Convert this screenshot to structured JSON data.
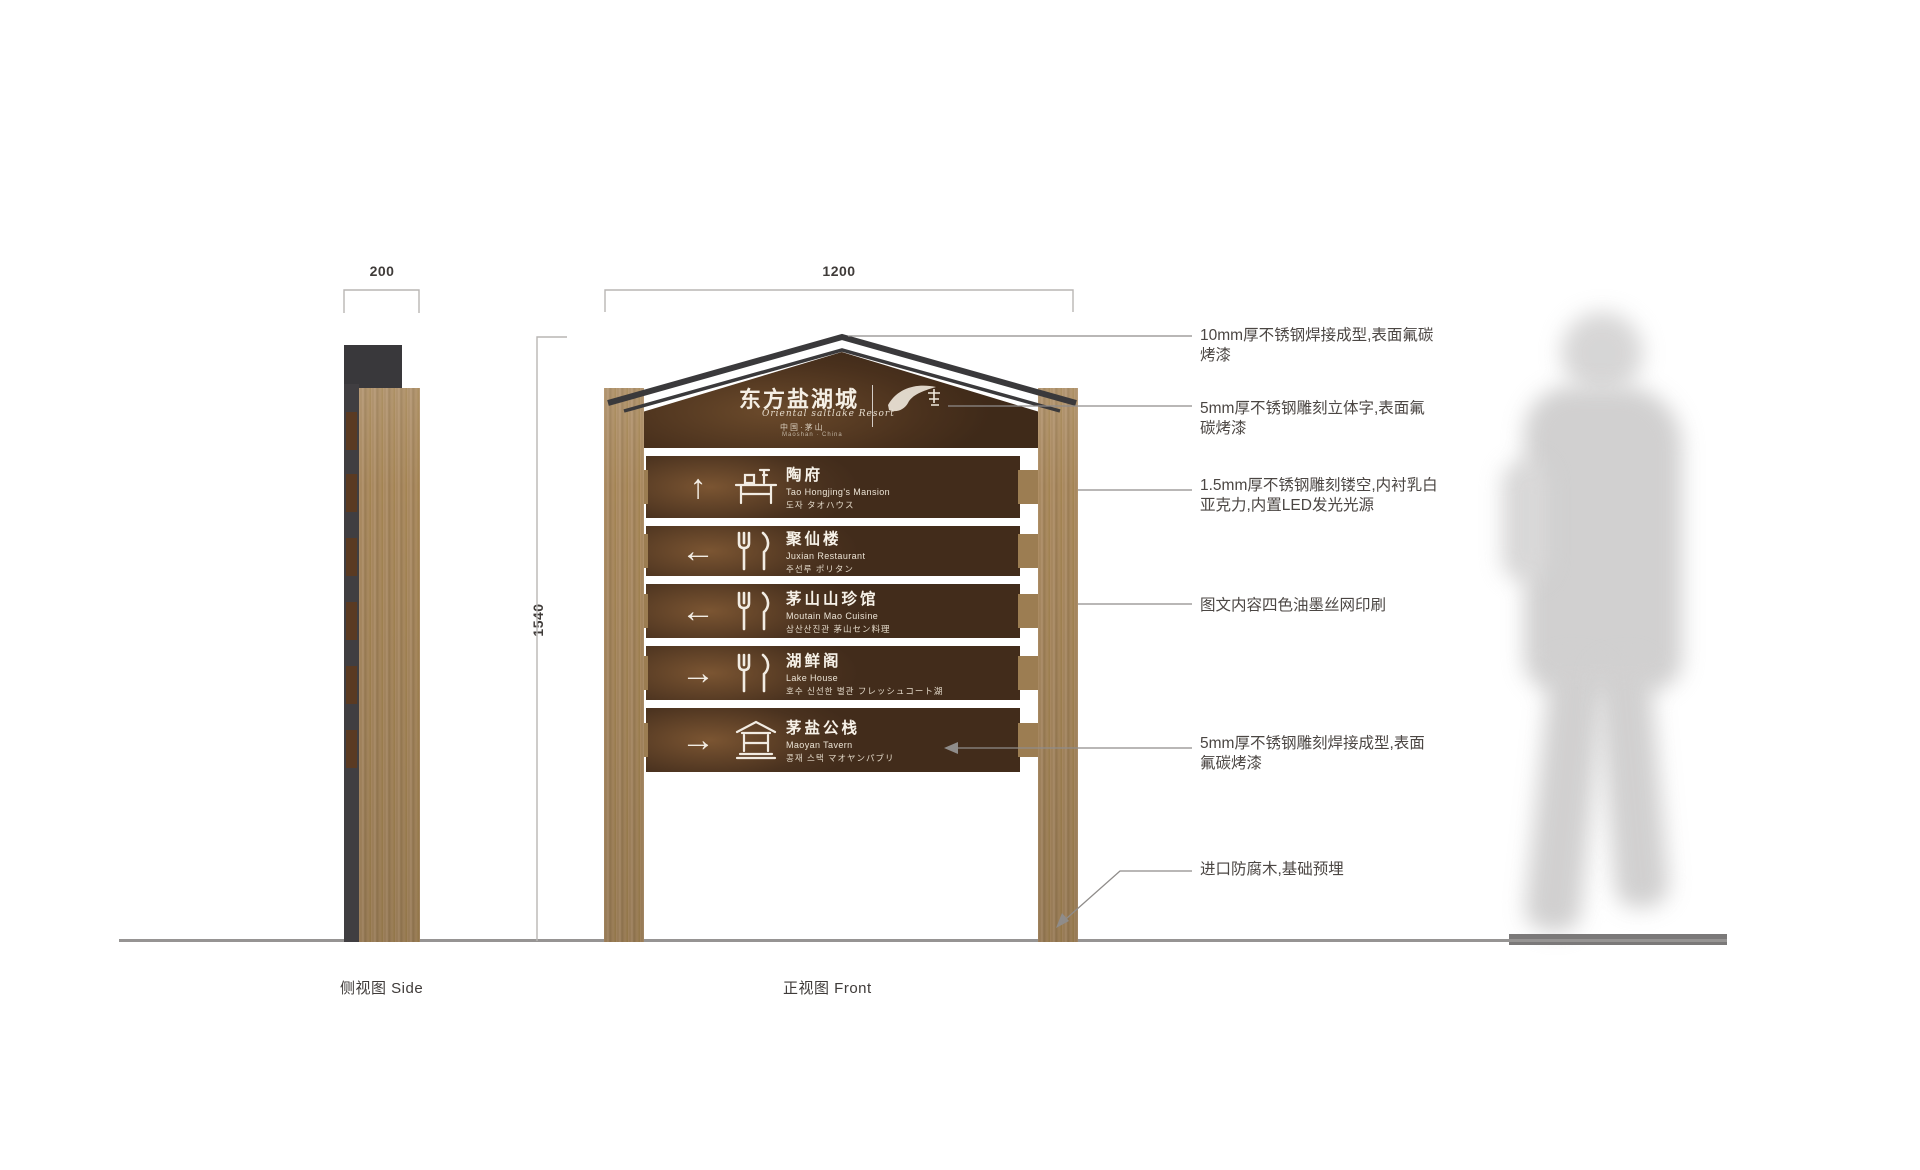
{
  "title_block": {
    "side_view_label": "侧视图 Side",
    "front_view_label": "正视图 Front"
  },
  "dimensions": {
    "side_width": "200",
    "front_width": "1200",
    "total_height": "1540"
  },
  "header": {
    "title": "东方盐湖城",
    "script_line": "Oriental saltlake Resort",
    "origin_line1": "中国·茅山",
    "origin_line2": "Maoshan · China"
  },
  "rows": [
    {
      "arrow": "up",
      "arrow_glyph": "↑",
      "icon": "mansion",
      "name_cn": "陶府",
      "name_en": "Tao Hongjing's Mansion",
      "name_intl": "도자 タオハウス"
    },
    {
      "arrow": "left",
      "arrow_glyph": "←",
      "icon": "dining",
      "name_cn": "聚仙楼",
      "name_en": "Juxian Restaurant",
      "name_intl": "주선루 ポリタン"
    },
    {
      "arrow": "left",
      "arrow_glyph": "←",
      "icon": "dining",
      "name_cn": "茅山山珍馆",
      "name_en": "Moutain Mao Cuisine",
      "name_intl": "삼산산진관 茅山セン料理"
    },
    {
      "arrow": "right",
      "arrow_glyph": "→",
      "icon": "dining",
      "name_cn": "湖鲜阁",
      "name_en": "Lake House",
      "name_intl": "호수 신선한 별관 フレッシュコート湖"
    },
    {
      "arrow": "right",
      "arrow_glyph": "→",
      "icon": "tavern",
      "name_cn": "茅盐公栈",
      "name_en": "Maoyan Tavern",
      "name_intl": "콩재 스택 マオヤンパブリ"
    }
  ],
  "annotations": [
    {
      "text": "10mm厚不锈钢焊接成型,表面氟碳烤漆"
    },
    {
      "text": "5mm厚不锈钢雕刻立体字,表面氟碳烤漆"
    },
    {
      "text": "1.5mm厚不锈钢雕刻镂空,内衬乳白亚克力,内置LED发光光源"
    },
    {
      "text": "图文内容四色油墨丝网印刷"
    },
    {
      "text": "5mm厚不锈钢雕刻焊接成型,表面氟碳烤漆"
    },
    {
      "text": "进口防腐木,基础预埋"
    }
  ],
  "colors": {
    "board_dark": "#4a321f",
    "board_sheen": "#7b5532",
    "wood": "#a8885c",
    "steel_dark": "#39383b",
    "annotation_text": "#4b4643",
    "line_gray": "#8f8c8a"
  },
  "icons": [
    "direction-arrow",
    "mansion-icon",
    "dining-icon",
    "tavern-icon",
    "calligraphy-brand-mark"
  ]
}
